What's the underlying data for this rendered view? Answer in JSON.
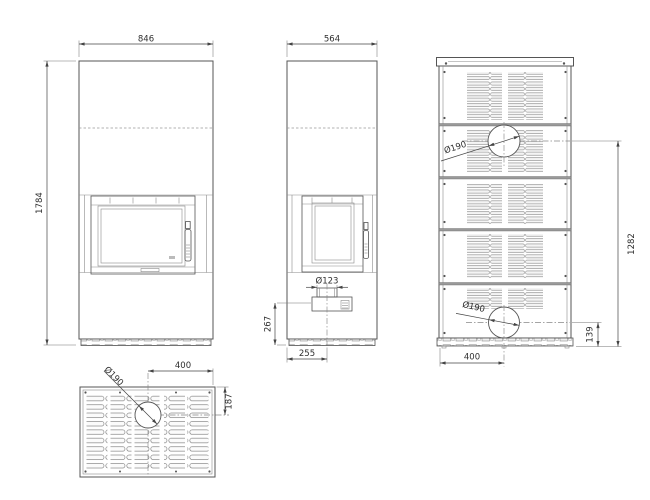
{
  "drawing_type": "fireplace-technical-drawing",
  "colors": {
    "line": "#555555",
    "dim_text": "#2e2e2e",
    "light_line": "#999999",
    "background": "#ffffff"
  },
  "views": {
    "front": {
      "width": "846",
      "height": "1784"
    },
    "side": {
      "width": "564",
      "flue_diameter": "Ø123",
      "flue_center_height": "267",
      "flue_center_offset": "255"
    },
    "back": {
      "upper_outlet_diameter": "Ø190",
      "lower_outlet_diameter": "Ø190",
      "upper_outlet_height": "1282",
      "lower_outlet_height": "139",
      "outlet_offset": "400"
    },
    "top": {
      "outlet_diameter": "Ø190",
      "outlet_offset_x": "400",
      "outlet_offset_y": "187"
    }
  }
}
